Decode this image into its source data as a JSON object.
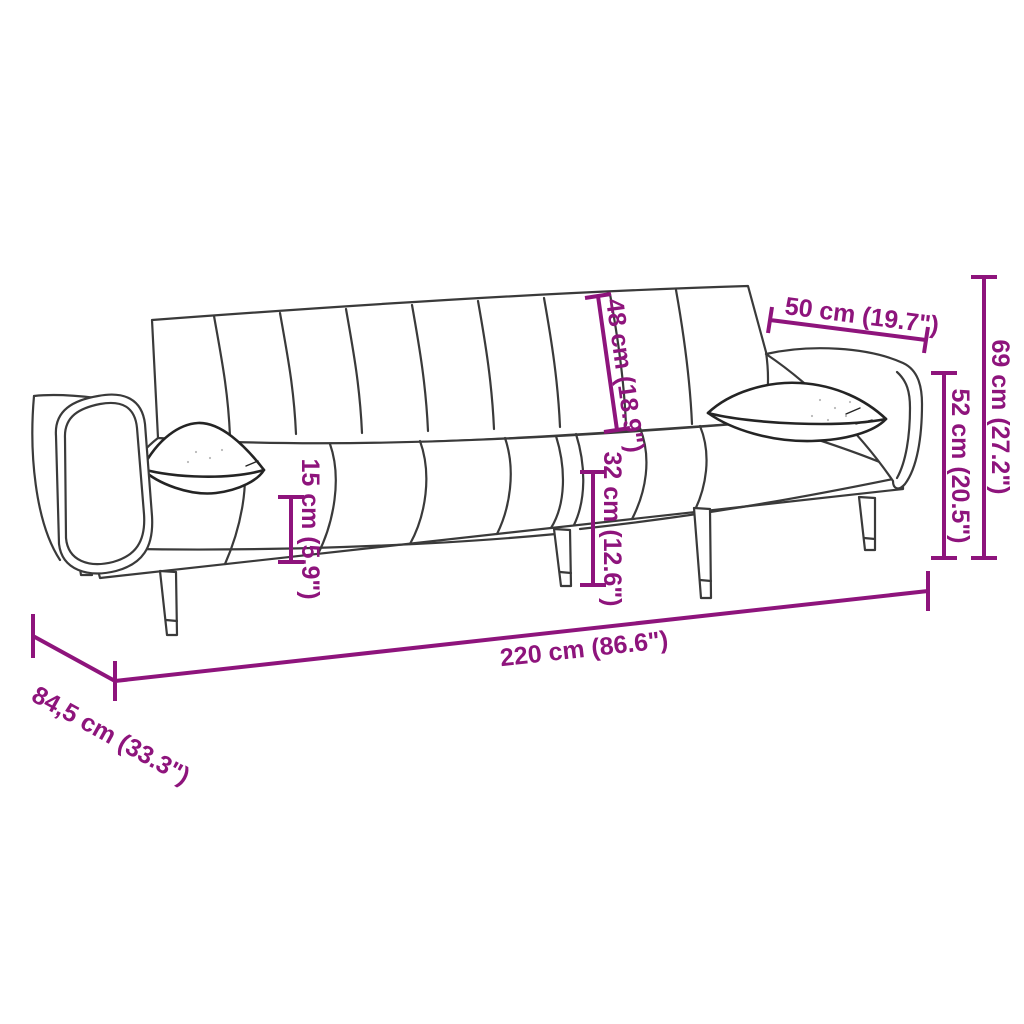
{
  "image": {
    "type": "product-dimension-diagram",
    "subject": "sofa-bed-with-two-pillows",
    "background_color": "#FFFFFF",
    "accent_color": "#8E147C",
    "outline_color": "#3A3A3A"
  },
  "dimensions": {
    "overall_width": "220 cm (86.6\")",
    "overall_depth": "84,5 cm (33.3\")",
    "overall_height": "69 cm (27.2\")",
    "armrest_height": "52 cm (20.5\")",
    "cushion_width": "50 cm (19.7\")",
    "backrest_height": "48 cm (18.9\")",
    "seat_height": "15 cm (5.9\")",
    "seat_front_height": "32 cm (12.6\")"
  }
}
